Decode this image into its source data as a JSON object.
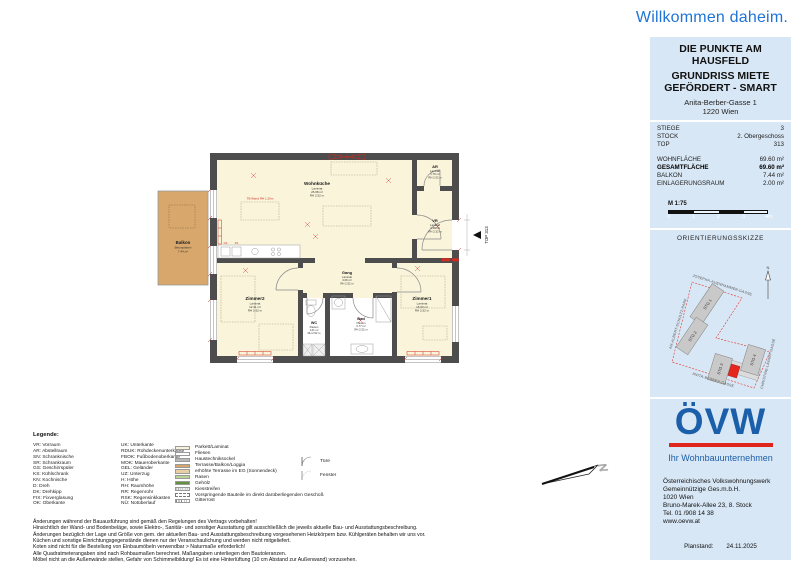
{
  "header": {
    "welcome": "Willkommen daheim."
  },
  "title_box": {
    "project": "DIE PUNKTE AM HAUSFELD",
    "subtitle": "GRUNDRISS MIETE GEFÖRDERT - SMART",
    "address_line1": "Anita-Berber-Gasse 1",
    "address_line2": "1220 Wien"
  },
  "info_box": {
    "rows": [
      {
        "label": "STIEGE",
        "value": "3"
      },
      {
        "label": "STOCK",
        "value": "2. Obergeschoss"
      },
      {
        "label": "TOP",
        "value": "313"
      }
    ],
    "areas": [
      {
        "label": "WOHNFLÄCHE",
        "value": "69.60 m²"
      },
      {
        "label": "GESAMTFLÄCHE",
        "value": "69.60 m²"
      },
      {
        "label": "BALKON",
        "value": "7.44 m²"
      },
      {
        "label": "EINLAGERUNGSRAUM",
        "value": "2.00 m²"
      }
    ],
    "scale_label": "M 1:75",
    "scale_ticks": [
      "0",
      "1",
      "2",
      "3",
      "4m"
    ]
  },
  "orientation": {
    "title": "ORIENTIERUNGSSKIZZE",
    "streets": {
      "top": "JOSEPHA-AUENHAMMER-GASSE",
      "left": "AM-ALBERT-SCHULTZ-PARK",
      "bottom": "ANITA-BERBER-GASSE",
      "right": "CHRISTINE-LAVANT-GASSE"
    },
    "buildings": {
      "stg1": "STG 1",
      "stg2": "STG 2",
      "stg3": "STG 3",
      "stg4": "STG 4"
    },
    "north": "N"
  },
  "plan": {
    "rooms": {
      "wohnkueche": {
        "name": "Wohnküche",
        "floor": "Laminat",
        "area": "26.68 m²",
        "rh": "RH 2.52 m"
      },
      "ar": {
        "name": "AR",
        "floor": "Laminat",
        "area": "1.76 m²",
        "rh": "RH 2.52 m"
      },
      "vr": {
        "name": "VR",
        "floor": "Laminat",
        "area": "3.38 m²",
        "rh": "RH 2.52 m"
      },
      "gang": {
        "name": "Gang",
        "floor": "Laminat",
        "area": "4.06 m²",
        "rh": "RH 2.52 m"
      },
      "zimmer1": {
        "name": "Zimmer1",
        "floor": "Laminat",
        "area": "16.03 m²",
        "rh": "RH 2.52 m"
      },
      "zimmer2": {
        "name": "Zimmer2",
        "floor": "Laminat",
        "area": "12.31 m²",
        "rh": "RH 2.52 m"
      },
      "bad": {
        "name": "Bad",
        "floor": "Fliesen",
        "area": "3.77 m²",
        "rh": "RH 2.52 m"
      },
      "wc": {
        "name": "WC",
        "floor": "Fliesen",
        "area": "1.61 m²",
        "rh": "RH 2.52 m"
      }
    },
    "balkon": {
      "name": "Balkon",
      "floor": "Betonplatten",
      "area": "7.44 m²"
    },
    "top_label": "TOP 313",
    "tb_note": "TB Wand RH 1.20m",
    "kitchen": {
      "gs": "GS",
      "ks": "KS"
    },
    "north": "N"
  },
  "legend": {
    "heading": "Legende:",
    "col1": [
      "VR: Vorraum",
      "AR: Abstellraum",
      "SN: Schranknische",
      "SR: Schrankraum",
      "GS: Geschirrspüler",
      "KS: Kühlschrank",
      "KN: Kochnische",
      "D: Dreh",
      "DK: Drehkipp",
      "FIX: Fixverglasung",
      "OK: Oberkante"
    ],
    "col2": [
      "UK: Unterkante",
      "RDUK: Rohdeckenunterkante",
      "FBOK: Fußbodenoberkante",
      "MOK: Maueroberkante",
      "GEL: Geländer",
      "UZ: Unterzug",
      "H: Höhe",
      "RH: Raumhöhe",
      "RR: Regenrohr",
      "RSK: Regensinkkasten",
      "NÜ: Notüberlauf"
    ],
    "swatches": [
      "Parkett/Laminat",
      "Fliesen",
      "Haustechniksockel",
      "Terrasse/Balkon/Loggia",
      "erhöhte Terrasse im EG (Sonnendeck)",
      "Rasen",
      "Gehölz",
      "Kiesstreifen",
      "Vorspringende Bauteile im direkt darüberliegenden Geschoß",
      "Gitterrost"
    ],
    "symbols": {
      "door": "Türe",
      "window": "Fenster"
    }
  },
  "footnotes": [
    "Änderungen während der Bauausführung sind gemäß den Regelungen des Vertrags vorbehalten!",
    "Hinsichtlich der Wand- und Bodenbeläge, sowie Elektro-, Sanitär- und sonstiger Ausstattung gilt ausschließlich die jeweils aktuelle Bau- und Ausstattungsbeschreibung.",
    "Änderungen bezüglich der Lage und Größe von gem. der aktuellen Bau- und Ausstattungsbeschreibung vorgesehenen Heizkörpern bzw. Kühlgeräten behalten wir uns vor.",
    "Küchen und sonstige Einrichtungsgegenstände dienen nur der Veranschaulichung und werden nicht mitgeliefert.",
    "Koten sind nicht für die Bestellung von Einbaumöbeln verwendbar > Naturmaße erforderlich!",
    "Alle Quadratmeterangaben sind nach Rohbaumaßen berechnet. Maßangaben unterliegen den Bautoleranzen.",
    "Möbel nicht an die Außenwände stellen, Gefahr von Schimmelbildung! Es ist eine Hinterlüftung (10 cm Abstand zur Außenwand) vorzusehen."
  ],
  "brand": {
    "logo": "ÖVW",
    "tagline": "Ihr Wohnbauunternehmen",
    "address_lines": [
      "Österreichisches Volkswohnungswerk",
      "Gemeinnützige Ges.m.b.H.",
      "1020 Wien",
      "Bruno-Marek-Allee 23, 8. Stock",
      "Tel. 01 /908 14 38",
      "www.oevw.at"
    ],
    "planstand_label": "Planstand:",
    "planstand_value": "24.11.2025"
  }
}
